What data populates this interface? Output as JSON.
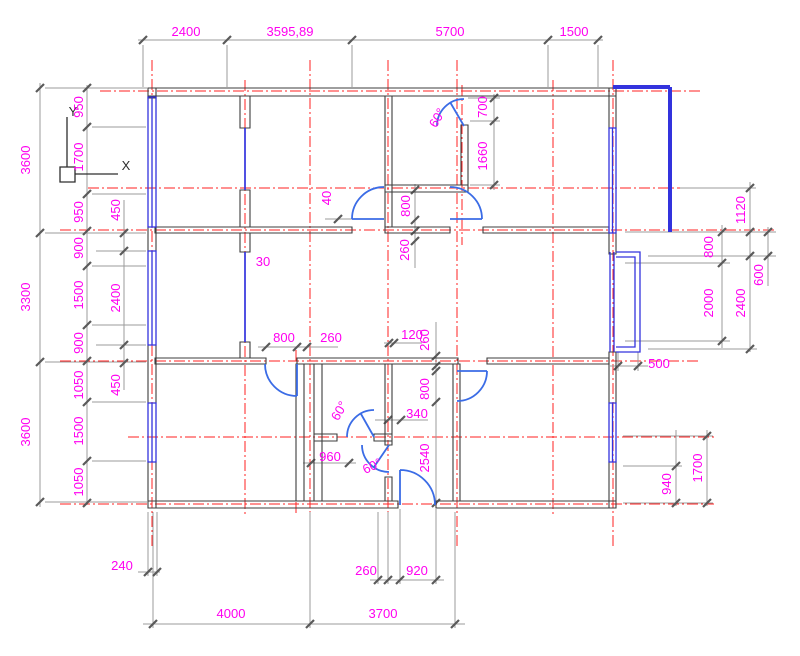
{
  "drawing": {
    "type": "cad-floor-plan",
    "units": "mm",
    "colors": {
      "dimension_text": "#ff00f0",
      "wall": "#3d3d3d",
      "window_glazing": "#3333dd",
      "door": "#3b6ce6",
      "centerline": "#ff2222",
      "dimension_line": "#9b9b9b",
      "background": "#ffffff"
    }
  },
  "ucs": {
    "x": "X",
    "y": "Y"
  },
  "dims": {
    "top": [
      "2400",
      "3595,89",
      "5700",
      "1500"
    ],
    "left_outer": [
      "3600",
      "3300",
      "3600"
    ],
    "left_inner": [
      "950",
      "1700",
      "950",
      "900",
      "1500",
      "900",
      "1050",
      "1500",
      "1050"
    ],
    "left_inner2": [
      "450",
      "2400",
      "450"
    ],
    "right_upper": [
      "1120",
      "800",
      "600",
      "2000",
      "2400",
      "500"
    ],
    "right_lower": [
      "940",
      "1700"
    ],
    "bottom": [
      "240",
      "260",
      "920",
      "4000",
      "3700"
    ],
    "interior": {
      "d40": "40",
      "v800": "800",
      "v260": "260",
      "d30": "30",
      "h800": "800",
      "h260": "260",
      "h120": "120",
      "w260": "260",
      "dw800": "800",
      "d340": "340",
      "d2540": "2540",
      "d960": "960",
      "d700": "700",
      "d1660": "1660",
      "angle1": "60°",
      "angle2": "60°",
      "angle3": "60°"
    }
  }
}
